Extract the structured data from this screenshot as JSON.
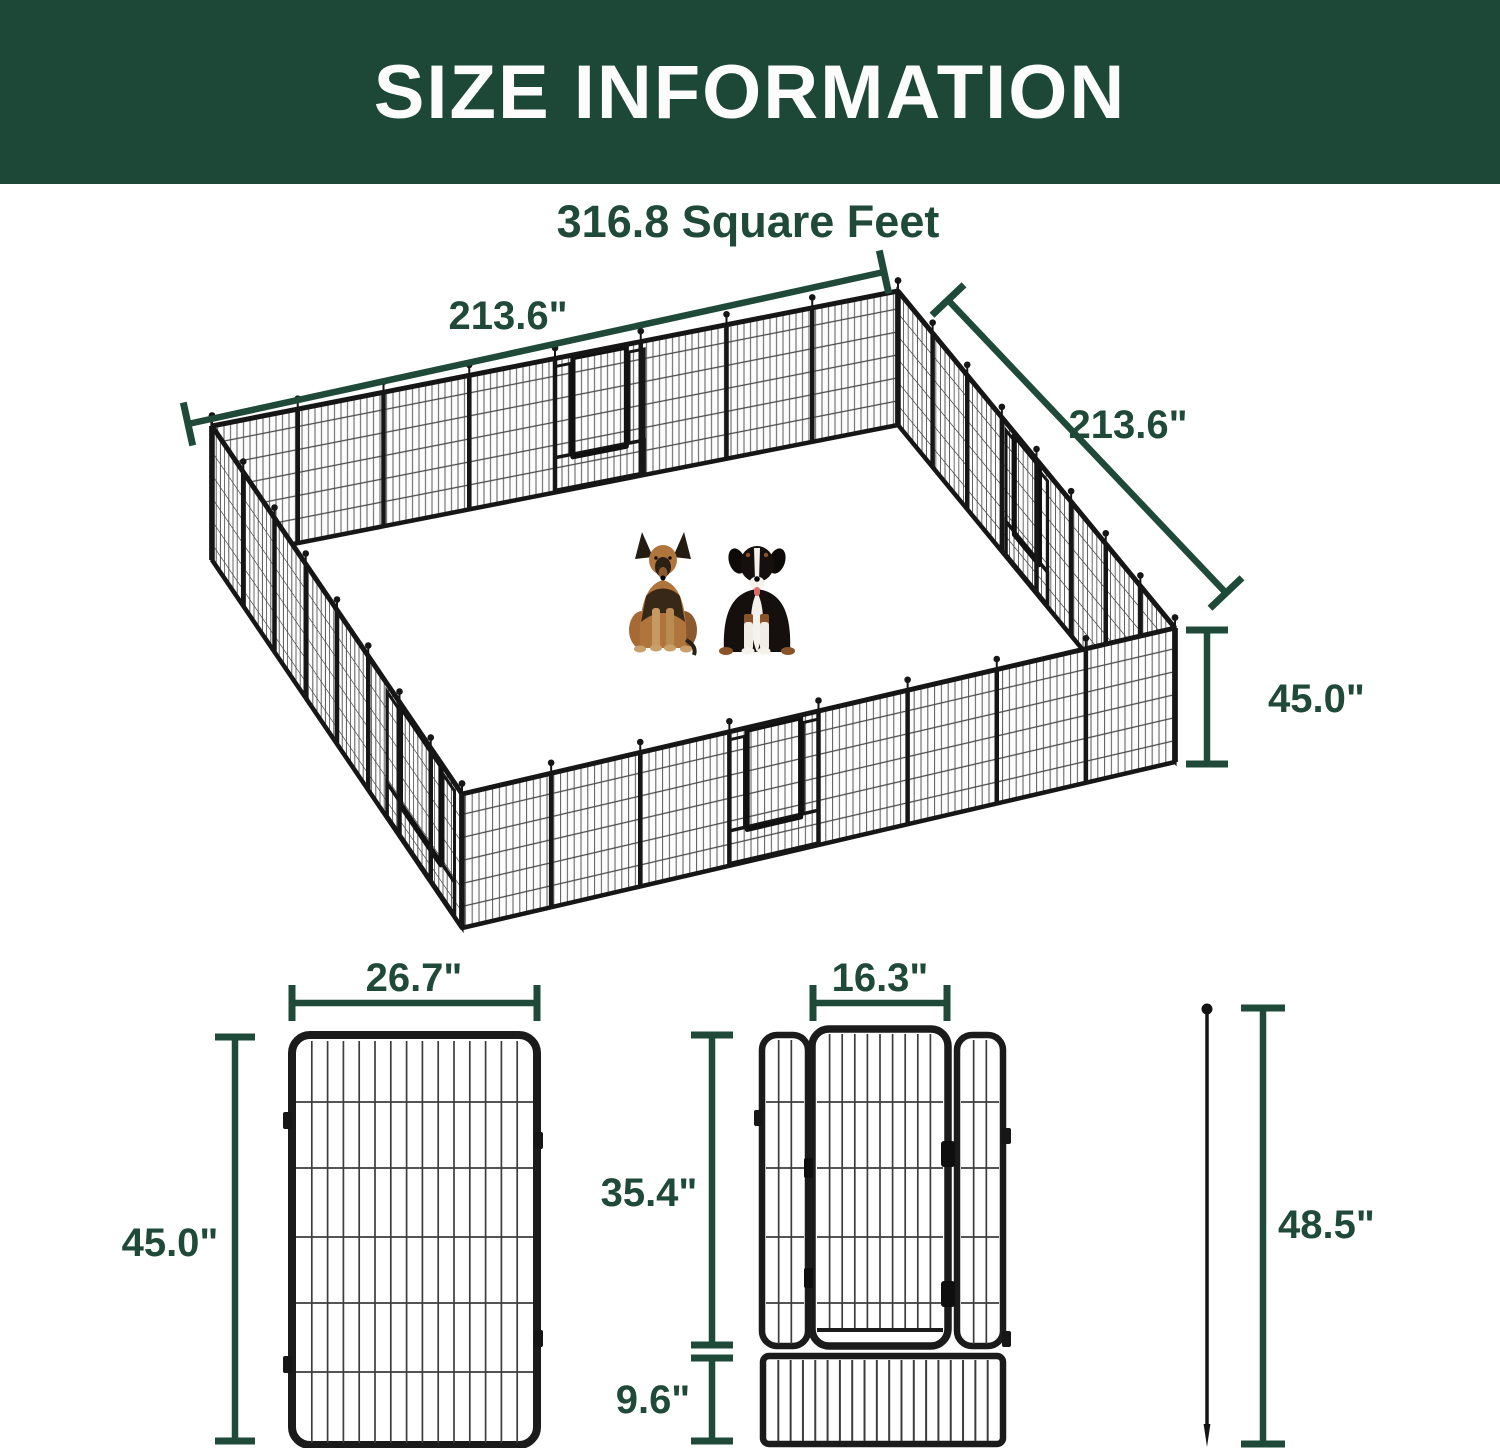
{
  "header": {
    "title": "SIZE INFORMATION"
  },
  "overview": {
    "area": "316.8 Square Feet",
    "width": "213.6\"",
    "depth": "213.6\"",
    "height": "45.0\"",
    "illustration_dogs": [
      "german-shepherd",
      "bernese-mountain-dog"
    ]
  },
  "panel_detail": {
    "width": "26.7\"",
    "height": "45.0\""
  },
  "door_panel_detail": {
    "door_width": "16.3\"",
    "door_height": "35.4\"",
    "bottom_height": "9.6\""
  },
  "stake_detail": {
    "length": "48.5\""
  },
  "colors": {
    "header_green": "#1d4737",
    "accent_green": "#1f4a39",
    "fence_black": "#1b1b1b",
    "background": "#ffffff"
  }
}
